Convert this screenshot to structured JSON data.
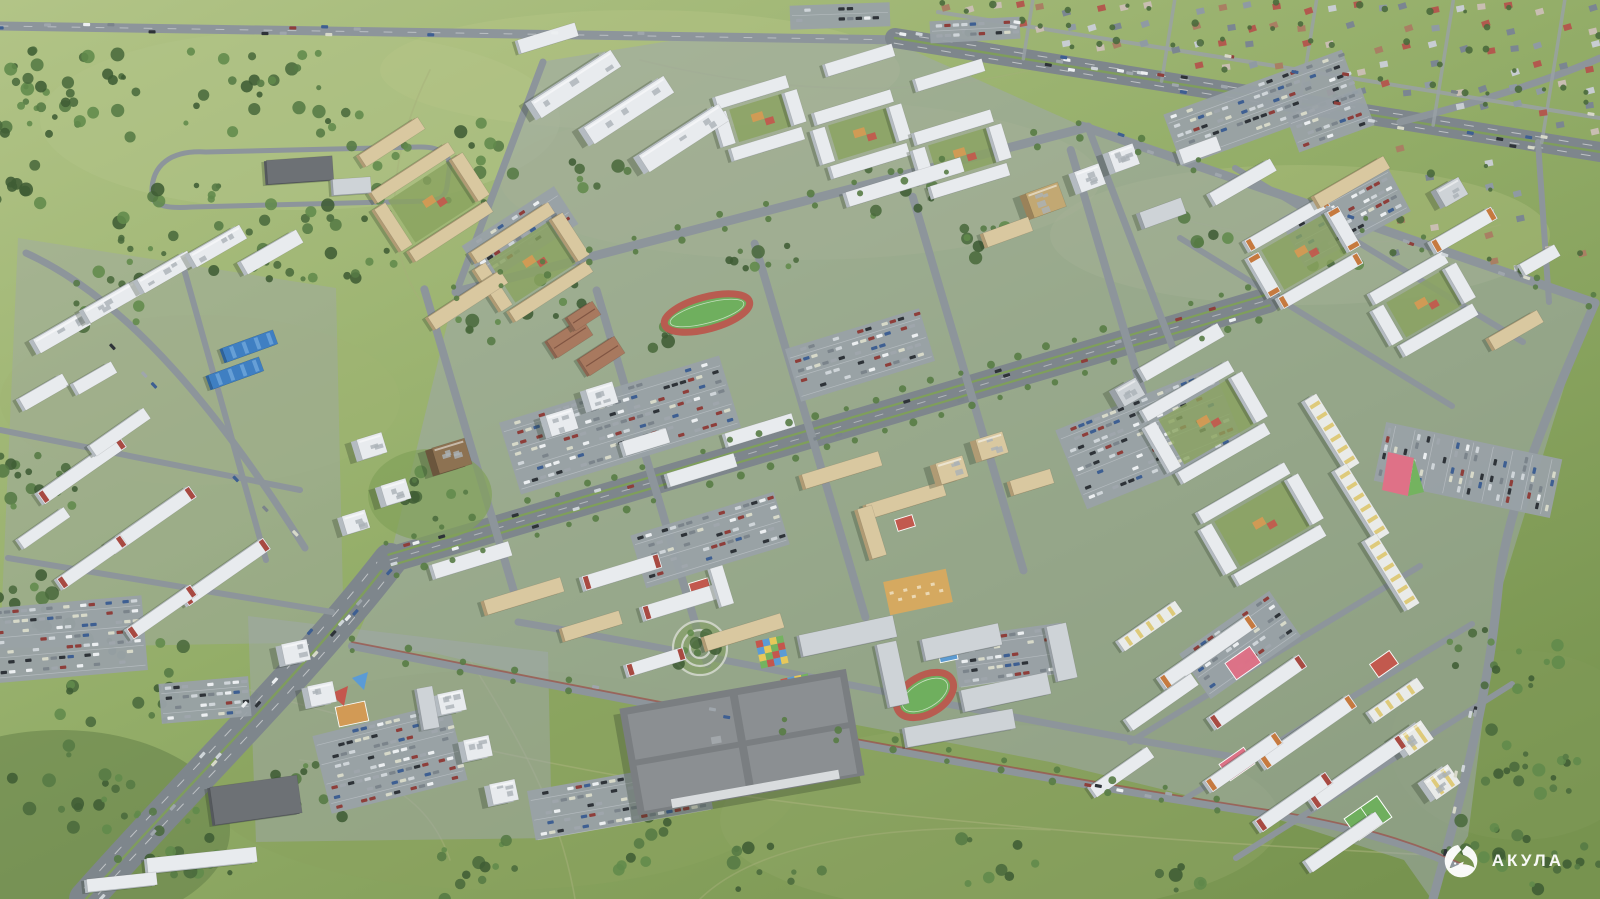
{
  "watermark": {
    "text": "АКУЛА",
    "icon": "shark-icon",
    "color": "#ffffff"
  },
  "palette": {
    "field_light": "#b2c487",
    "field_mid": "#93ad68",
    "field_dark": "#77934f",
    "woods": "#4a6a3c",
    "road": "#8d959b",
    "highway": "#7e868c",
    "district_ground": "#9fa7ab",
    "median_green": "#7fa058",
    "building_white_roof": "#e8ebee",
    "building_white_wall": "#b4bbc1",
    "building_tan_roof": "#d9c8a0",
    "building_tan_wall": "#b09b74",
    "building_grey_roof": "#ced3d7",
    "building_grey_wall": "#9aa1a7",
    "accent_red": "#a84a42",
    "accent_orange": "#c67a3f",
    "accent_yellow": "#ddc76e",
    "brown_tower_roof": "#8d7252",
    "brown_tower_wall": "#6b563d",
    "blue_warehouse": "#3f7fc2",
    "school_roof": "#a8795f",
    "playground_red": "#c4574d",
    "playground_pink": "#df7187",
    "playground_blue": "#5b9bd5",
    "playground_green": "#74b35f",
    "playground_orange": "#d49a54",
    "playground_yellow": "#e7c85a",
    "stadium_track": "#b85c50",
    "pitch_green": "#6faf5e",
    "dirt_path": "#a6b07a",
    "bike_lane": "#9c4f45",
    "shadow": "rgba(40,55,35,0.28)"
  }
}
